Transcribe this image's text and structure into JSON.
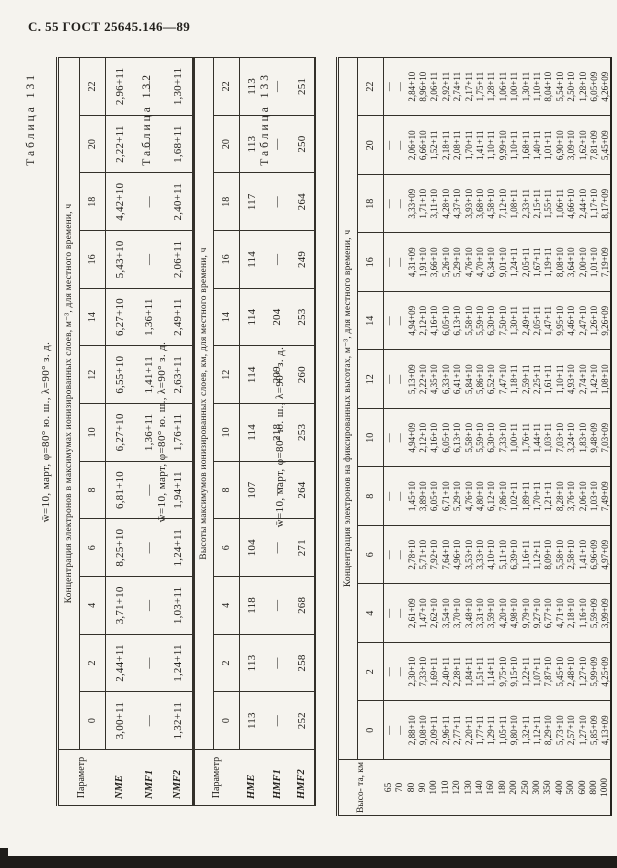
{
  "page": {
    "header": "С. 55 ГОСТ 25645.146—89"
  },
  "times": [
    "0",
    "2",
    "4",
    "6",
    "8",
    "10",
    "12",
    "14",
    "16",
    "18",
    "20",
    "22"
  ],
  "tables": [
    {
      "caption": "Таблица 131",
      "title": "w̄=10, март, φ=80° ю. ш., λ=90° з. д.",
      "corner": "Параметр",
      "span_header": "Концентрация электронов в максимумах ионизированных слоев, м⁻³, для местного времени, ч",
      "rows": [
        {
          "label": "NME",
          "values": [
            "3,00+11",
            "2,44+11",
            "3,71+10",
            "8,25+10",
            "6,81+10",
            "6,27+10",
            "6,55+10",
            "6,27+10",
            "5,43+10",
            "4,42+10",
            "2,22+11",
            "2,96+11"
          ]
        },
        {
          "label": "NMF1",
          "values": [
            "—",
            "—",
            "—",
            "—",
            "—",
            "1,36+11",
            "1,41+11",
            "1,36+11",
            "—",
            "—",
            "—",
            "—"
          ]
        },
        {
          "label": "NMF2",
          "values": [
            "1,32+11",
            "1,24+11",
            "1,03+11",
            "1,24+11",
            "1,94+11",
            "1,76+11",
            "2,63+11",
            "2,49+11",
            "2,06+11",
            "2,40+11",
            "1,68+11",
            "1,30+11"
          ]
        }
      ]
    },
    {
      "caption": "Таблица 132",
      "title": "w̄=10, март, φ=80° ю. ш., λ=90° з. д.",
      "corner": "Параметр",
      "span_header": "Высоты максимумов ионизированных слоев, км, для местного времени, ч",
      "rows": [
        {
          "label": "HME",
          "values": [
            "113",
            "113",
            "118",
            "104",
            "107",
            "114",
            "114",
            "114",
            "114",
            "117",
            "113",
            "113"
          ]
        },
        {
          "label": "HMF1",
          "values": [
            "—",
            "—",
            "—",
            "—",
            "—",
            "218",
            "209",
            "204",
            "—",
            "—",
            "—",
            "—"
          ]
        },
        {
          "label": "HMF2",
          "values": [
            "252",
            "258",
            "268",
            "271",
            "264",
            "253",
            "260",
            "253",
            "249",
            "264",
            "250",
            "251"
          ]
        }
      ]
    },
    {
      "caption": "Таблица 133",
      "title": "w̄=10, март, φ=80° ю. ш., λ=90° з. д.",
      "corner": "Высо- та, км",
      "span_header": "Концентрация электронов на фиксированных высотах, м⁻³, для местного времени, ч",
      "heights": [
        "65",
        "70",
        "80",
        "90",
        "100",
        "110",
        "120",
        "130",
        "140",
        "160",
        "180",
        "200",
        "250",
        "300",
        "350",
        "400",
        "500",
        "600",
        "800",
        "1000"
      ],
      "columns_by_time": [
        {
          "time": "0",
          "values": [
            "—",
            "—",
            "2,88+10",
            "9,08+10",
            "2,09+11",
            "2,96+11",
            "2,77+11",
            "2,20+11",
            "1,77+11",
            "1,29+11",
            "1,05+11",
            "9,80+10",
            "1,32+11",
            "1,12+11",
            "8,29+10",
            "5,73+10",
            "2,57+10",
            "1,27+10",
            "5,85+09",
            "4,13+09"
          ]
        },
        {
          "time": "2",
          "values": [
            "—",
            "—",
            "2,30+10",
            "7,33+10",
            "1,69+11",
            "2,40+11",
            "2,28+11",
            "1,84+11",
            "1,51+11",
            "1,14+11",
            "9,75+10",
            "9,15+10",
            "1,22+11",
            "1,07+11",
            "7,87+10",
            "5,45+10",
            "2,48+10",
            "1,27+10",
            "5,99+09",
            "4,25+09"
          ]
        },
        {
          "time": "4",
          "values": [
            "—",
            "—",
            "2,61+09",
            "1,47+10",
            "2,62+10",
            "3,54+10",
            "3,70+10",
            "3,48+10",
            "3,31+10",
            "3,59+10",
            "4,20+10",
            "4,98+10",
            "9,79+10",
            "9,27+10",
            "6,77+10",
            "4,71+10",
            "2,18+10",
            "1,16+10",
            "5,59+09",
            "3,99+09"
          ]
        },
        {
          "time": "6",
          "values": [
            "—",
            "—",
            "2,78+10",
            "5,71+10",
            "7,92+10",
            "7,64+10",
            "4,96+10",
            "3,53+10",
            "3,33+10",
            "4,10+10",
            "5,11+10",
            "6,39+10",
            "1,16+11",
            "1,12+11",
            "8,09+10",
            "5,58+10",
            "2,58+10",
            "1,41+10",
            "6,96+09",
            "4,97+09"
          ]
        },
        {
          "time": "8",
          "values": [
            "—",
            "—",
            "1,45+10",
            "3,89+10",
            "6,05+10",
            "6,71+10",
            "5,29+10",
            "4,76+10",
            "4,80+10",
            "6,12+10",
            "7,86+10",
            "1,02+11",
            "1,89+11",
            "1,70+11",
            "1,21+11",
            "8,28+10",
            "3,76+10",
            "2,06+10",
            "1,03+10",
            "7,49+09"
          ]
        },
        {
          "time": "10",
          "values": [
            "—",
            "—",
            "4,94+09",
            "2,12+10",
            "4,16+10",
            "6,05+10",
            "6,13+10",
            "5,58+10",
            "5,59+10",
            "6,30+10",
            "7,33+10",
            "1,00+11",
            "1,76+11",
            "1,44+11",
            "1,03+11",
            "7,03+10",
            "3,24+10",
            "1,83+10",
            "9,48+09",
            "7,03+09"
          ]
        },
        {
          "time": "12",
          "values": [
            "—",
            "—",
            "5,13+09",
            "2,22+10",
            "4,35+10",
            "6,33+10",
            "6,41+10",
            "5,84+10",
            "5,86+10",
            "6,52+10",
            "7,47+10",
            "1,18+11",
            "2,59+11",
            "2,25+11",
            "1,61+11",
            "1,10+11",
            "4,93+10",
            "2,74+10",
            "1,42+10",
            "1,08+10"
          ]
        },
        {
          "time": "14",
          "values": [
            "—",
            "—",
            "4,94+09",
            "2,12+10",
            "4,16+10",
            "6,05+10",
            "6,13+10",
            "5,58+10",
            "5,59+10",
            "6,30+10",
            "7,50+10",
            "1,30+11",
            "2,49+11",
            "2,05+11",
            "1,47+11",
            "9,95+10",
            "4,46+10",
            "2,47+10",
            "1,26+10",
            "9,26+09"
          ]
        },
        {
          "time": "16",
          "values": [
            "—",
            "—",
            "4,31+09",
            "1,91+10",
            "3,66+10",
            "5,26+10",
            "5,29+10",
            "4,76+10",
            "4,70+10",
            "6,34+10",
            "9,01+10",
            "1,24+11",
            "2,05+11",
            "1,67+11",
            "1,19+11",
            "8,08+10",
            "3,64+10",
            "2,00+10",
            "1,01+10",
            "7,19+09"
          ]
        },
        {
          "time": "18",
          "values": [
            "—",
            "—",
            "3,33+09",
            "1,71+10",
            "3,11+10",
            "4,28+10",
            "4,37+10",
            "3,93+10",
            "3,68+10",
            "4,58+10",
            "7,12+10",
            "1,08+11",
            "2,33+11",
            "2,15+11",
            "1,55+11",
            "1,06+11",
            "4,66+10",
            "2,44+10",
            "1,17+10",
            "8,17+09"
          ]
        },
        {
          "time": "20",
          "values": [
            "—",
            "—",
            "2,06+10",
            "6,66+10",
            "1,52+11",
            "2,18+11",
            "2,08+11",
            "1,70+11",
            "1,41+11",
            "1,10+11",
            "9,99+10",
            "1,10+11",
            "1,68+11",
            "1,40+11",
            "1,01+11",
            "6,90+10",
            "3,09+10",
            "1,62+10",
            "7,81+09",
            "5,45+09"
          ]
        },
        {
          "time": "22",
          "values": [
            "—",
            "—",
            "2,84+10",
            "8,96+10",
            "2,06+11",
            "2,92+11",
            "2,74+11",
            "2,17+11",
            "1,75+11",
            "1,28+11",
            "1,06+11",
            "1,00+11",
            "1,30+11",
            "1,10+11",
            "8,04+10",
            "5,54+10",
            "2,50+10",
            "1,28+10",
            "6,05+09",
            "4,26+09"
          ]
        }
      ]
    }
  ]
}
